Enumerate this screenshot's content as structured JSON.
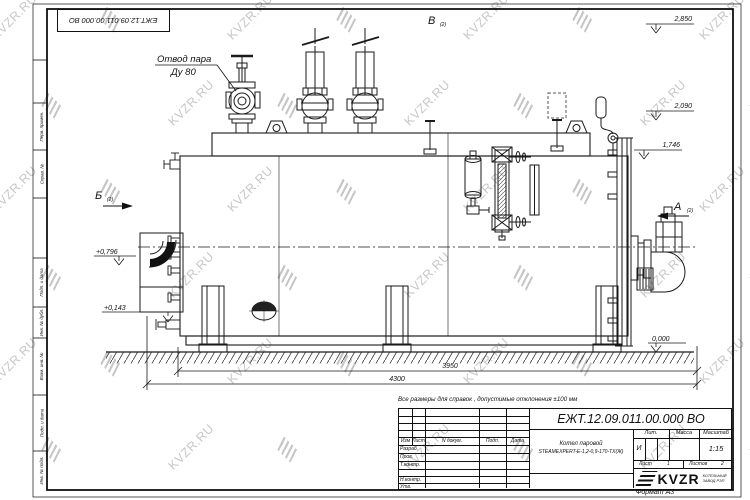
{
  "sheet": {
    "top_stamp": "ЕЖТ.12.09.011.00.000  ВО",
    "note": "Все размеры для справок , допустимые отклонения  ±100  мм",
    "format_label": "Формат А3"
  },
  "margin_labels": {
    "perv": "Перв. примен.",
    "sprav": "Справ. №",
    "podp1": "Подп. и дата",
    "inv_dubl": "Инв. № дубл.",
    "vzam": "Взам. инв. №",
    "podp2": "Подп. и дата",
    "inv_podl": "Инв. № подл."
  },
  "drawing": {
    "callout": {
      "line1": "Отвод пара",
      "line2": "Ду 80"
    },
    "views": {
      "v_top": "В",
      "v_left": "Б",
      "v_right": "А",
      "sub": "(2)"
    },
    "elevations": {
      "e1": "2,850",
      "e2": "2,090",
      "e3": "1,746",
      "e4": "+0,796",
      "e5": "+0,143",
      "e6": "0,000"
    },
    "dimensions": {
      "d1": "3950",
      "d2": "4300"
    }
  },
  "title_block": {
    "designation": "ЕЖТ.12.09.011.00.000  ВО",
    "name_line1": "Котел паровой",
    "name_line2": "STEAMEXPERT-Е-1,2-0,9-170-ТХ(Ж)",
    "header": {
      "izm": "Изм",
      "list": "Лист",
      "ndoc": "N докум.",
      "podp": "Подп.",
      "data": "Дата"
    },
    "rows": {
      "razrab": "Разраб.",
      "prov": "Пров.",
      "tkontr": "Т.контр.",
      "nkontr": "Н.контр.",
      "utv": "Утв."
    },
    "lit_label": "Лит.",
    "lit_value": "И",
    "massa_label": "Масса",
    "masshtab_label": "Масштаб",
    "masshtab_value": "1:15",
    "sheet_label": "Лист",
    "sheet_value": "1",
    "sheets_label": "Листов",
    "sheets_value": "2",
    "logo_text": "KVZR",
    "logo_sub1": "КОТЕЛЬНЫЙ",
    "logo_sub2": "ЗАВОД РЭП"
  },
  "watermark": {
    "text": "KVZR.RU"
  }
}
